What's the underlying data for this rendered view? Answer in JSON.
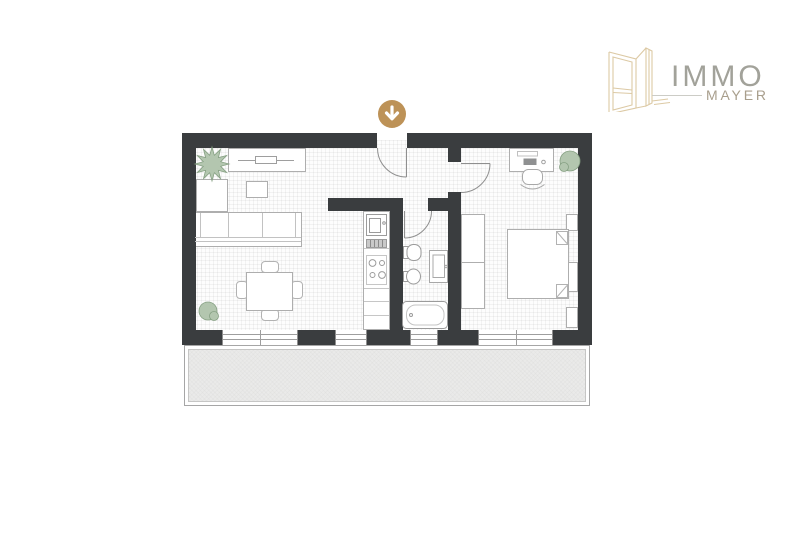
{
  "brand": {
    "primary": "IMMO",
    "secondary": "MAYER"
  },
  "colors": {
    "wall": "#3a3d3f",
    "accent_gold": "#bd9257",
    "plant_fill": "#b3c6af",
    "plant_stroke": "#86a083",
    "furniture_stroke": "#aeaeae",
    "balcony_fill": "#eaeae9",
    "brand_primary_text": "#a2a29a",
    "brand_secondary_text": "#a89e8c"
  },
  "icons": {
    "logo": "open-window-icon",
    "entrance": "arrow-down-icon"
  },
  "floorplan": {
    "items": [
      "sofa",
      "coffee-table",
      "tv-sideboard",
      "side-cabinet",
      "dining-table",
      "dining-chairs",
      "kitchen-counter",
      "sink",
      "stove",
      "toilet",
      "bidet",
      "bathtub",
      "washing-machine",
      "wardrobe",
      "double-bed",
      "nightstands",
      "desk",
      "desk-chair",
      "plants",
      "balcony",
      "entrance-door",
      "bathroom-door",
      "bedroom-door",
      "windows"
    ]
  }
}
